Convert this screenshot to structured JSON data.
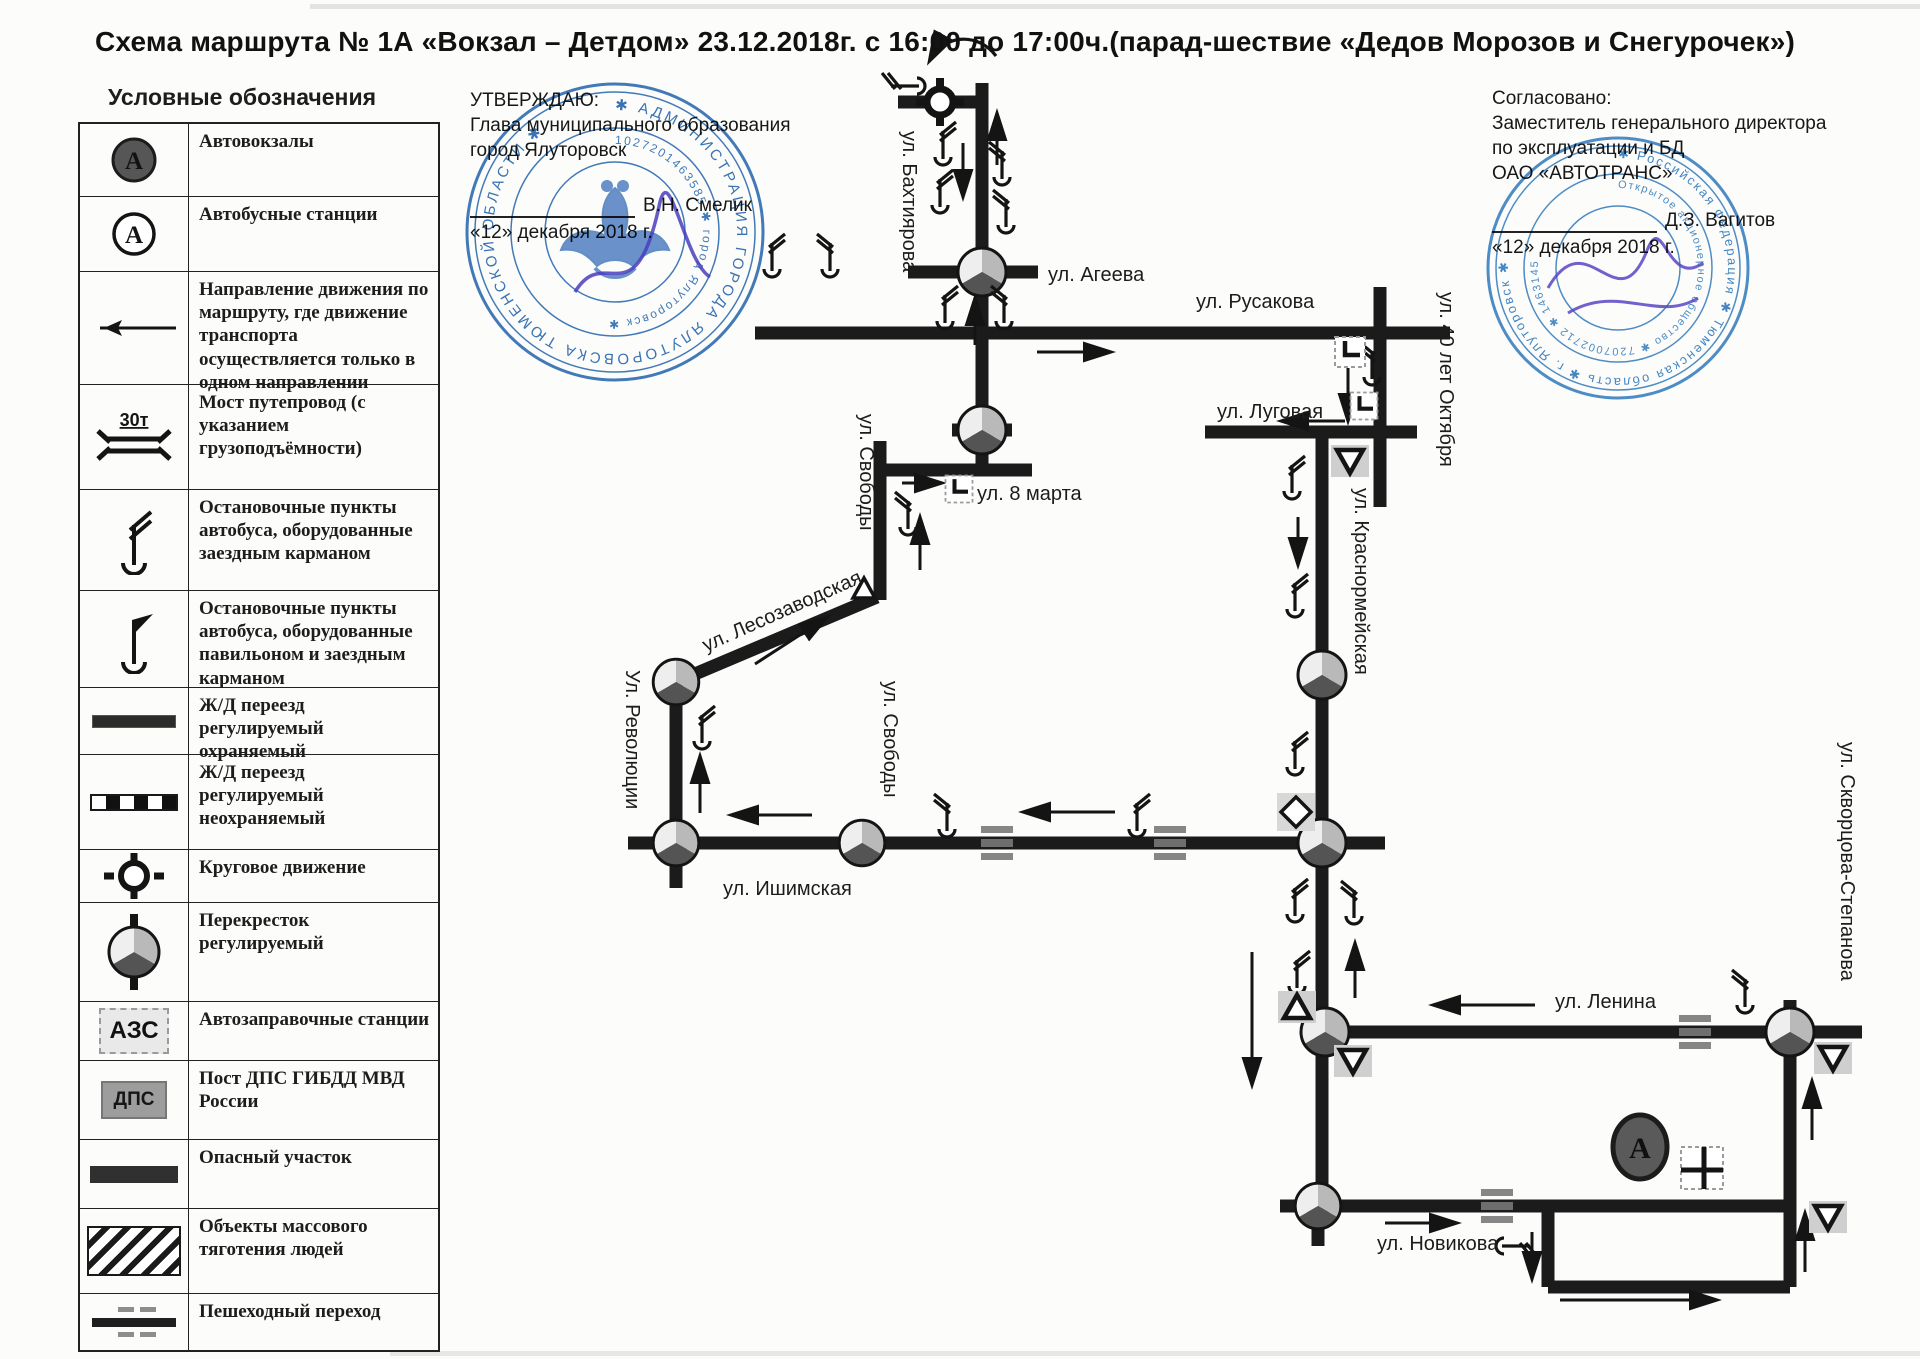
{
  "title": "Схема маршрута № 1А «Вокзал – Детдом» 23.12.2018г. с 16:00 до 17:00ч.(парад-шествие «Дедов Морозов и Снегурочек»)",
  "legend": {
    "header": "Условные обозначения",
    "rows": [
      {
        "label": "Автовокзалы",
        "icon": "bus-terminal",
        "icon_text": "А"
      },
      {
        "label": "Автобусные станции",
        "icon": "bus-station",
        "icon_text": "А"
      },
      {
        "label": "Направление движения по маршруту, где движение транспорта осуществляется только в одном направлении",
        "icon": "direction-arrow"
      },
      {
        "label": "Мост путепровод (с указанием грузоподъёмности)",
        "icon": "bridge",
        "icon_text": "30т"
      },
      {
        "label": "Остановочные пункты автобуса, оборудованные заездным карманом",
        "icon": "bus-stop"
      },
      {
        "label": "Остановочные пункты автобуса, оборудованные павильоном и заездным карманом",
        "icon": "bus-stop-pavilion"
      },
      {
        "label": "Ж/Д переезд регулируемый охраняемый",
        "icon": "railway-crossing-guarded"
      },
      {
        "label": "Ж/Д переезд регулируемый неохраняемый",
        "icon": "railway-crossing-unguarded"
      },
      {
        "label": "Круговое движение",
        "icon": "roundabout"
      },
      {
        "label": "Перекресток регулируемый",
        "icon": "signal-intersection"
      },
      {
        "label": "Автозаправочные станции",
        "icon": "fuel-station",
        "icon_text": "АЗС"
      },
      {
        "label": "Пост ДПС ГИБДД МВД России",
        "icon": "police-post",
        "icon_text": "ДПС"
      },
      {
        "label": "Опасный участок",
        "icon": "danger-section"
      },
      {
        "label": "Объекты массового тяготения людей",
        "icon": "crowd-object"
      },
      {
        "label": "Пешеходный переход",
        "icon": "pedestrian-crossing"
      }
    ]
  },
  "approval": {
    "line1": "УТВЕРЖДАЮ:",
    "line2": "Глава муниципального образования",
    "line3": "город Ялуторовск",
    "signature_name": "В.Н. Смелик",
    "date": "«12» декабря 2018 г."
  },
  "agreement": {
    "line1": "Согласовано:",
    "line2": "Заместитель генерального директора",
    "line3": "по эксплуатации и БД",
    "line4": "ОАО «АВТОТРАНС»",
    "signature_name": "Д.З. Вагитов",
    "date": "«12» декабря 2018 г."
  },
  "stamps": {
    "left": {
      "ring_text": "✱ АДМИНИСТРАЦИЯ ГОРОДА ЯЛУТОРОВСКА ТЮМЕНСКОЙ ОБЛАСТИ ✱",
      "inner_text": "1027201463585 ✱ город Ялуторовск ✱"
    },
    "right": {
      "ring_text": "✱ Российская Федерация ✱ Тюменская область ✱ г. Ялуторовск ✱",
      "inner_text": "Открытое акционерное общество ✱ 7207002712 ✱ 1463145"
    }
  },
  "map": {
    "terminal_label": "А",
    "streets": [
      {
        "label": "ул. Бахтиярова"
      },
      {
        "label": "ул. Агеева"
      },
      {
        "label": "ул. Русакова"
      },
      {
        "label": "ул. Луговая"
      },
      {
        "label": "ул. 40 лет Октября"
      },
      {
        "label": "ул. 8 марта"
      },
      {
        "label": "ул. Свободы"
      },
      {
        "label": "ул. Лесозаводская"
      },
      {
        "label": "Ул. Революции"
      },
      {
        "label": "ул. Свободы"
      },
      {
        "label": "ул. Ишимская"
      },
      {
        "label": "ул. Краснормейская"
      },
      {
        "label": "ул. Ленина"
      },
      {
        "label": "ул. Скворцова-Степанова"
      },
      {
        "label": "ул. Новикова"
      }
    ]
  }
}
